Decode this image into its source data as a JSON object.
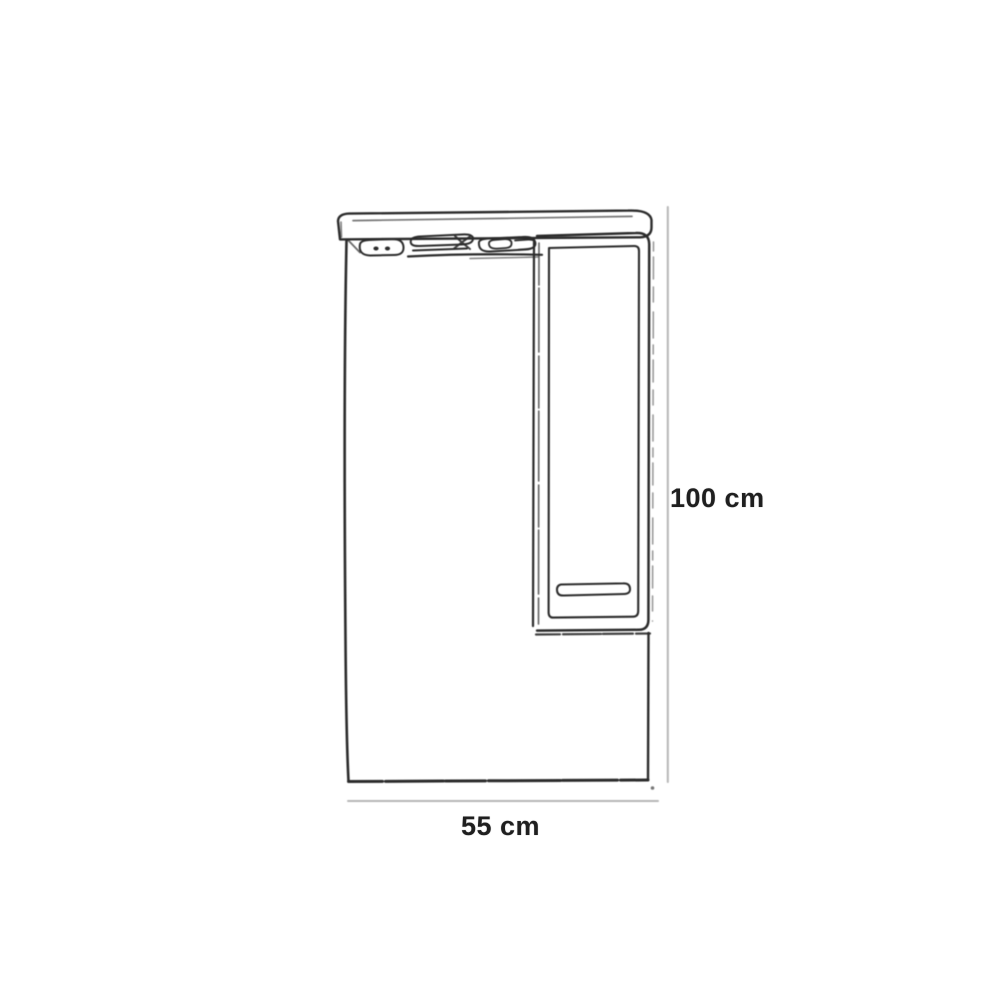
{
  "diagram": {
    "height_dimension_label": "100 cm",
    "width_dimension_label": "55 cm",
    "parts": {
      "canopy": "light-canopy",
      "lights": "light-fixtures",
      "mirror": "mirror-panel",
      "cabinet": "side-cabinet-with-door",
      "handle": "door-handle"
    },
    "colors": {
      "background": "#ffffff",
      "sketch_line": "#2b2b2b",
      "dimension_line": "#b6b6b6",
      "label_text": "#1f1f1f"
    }
  }
}
